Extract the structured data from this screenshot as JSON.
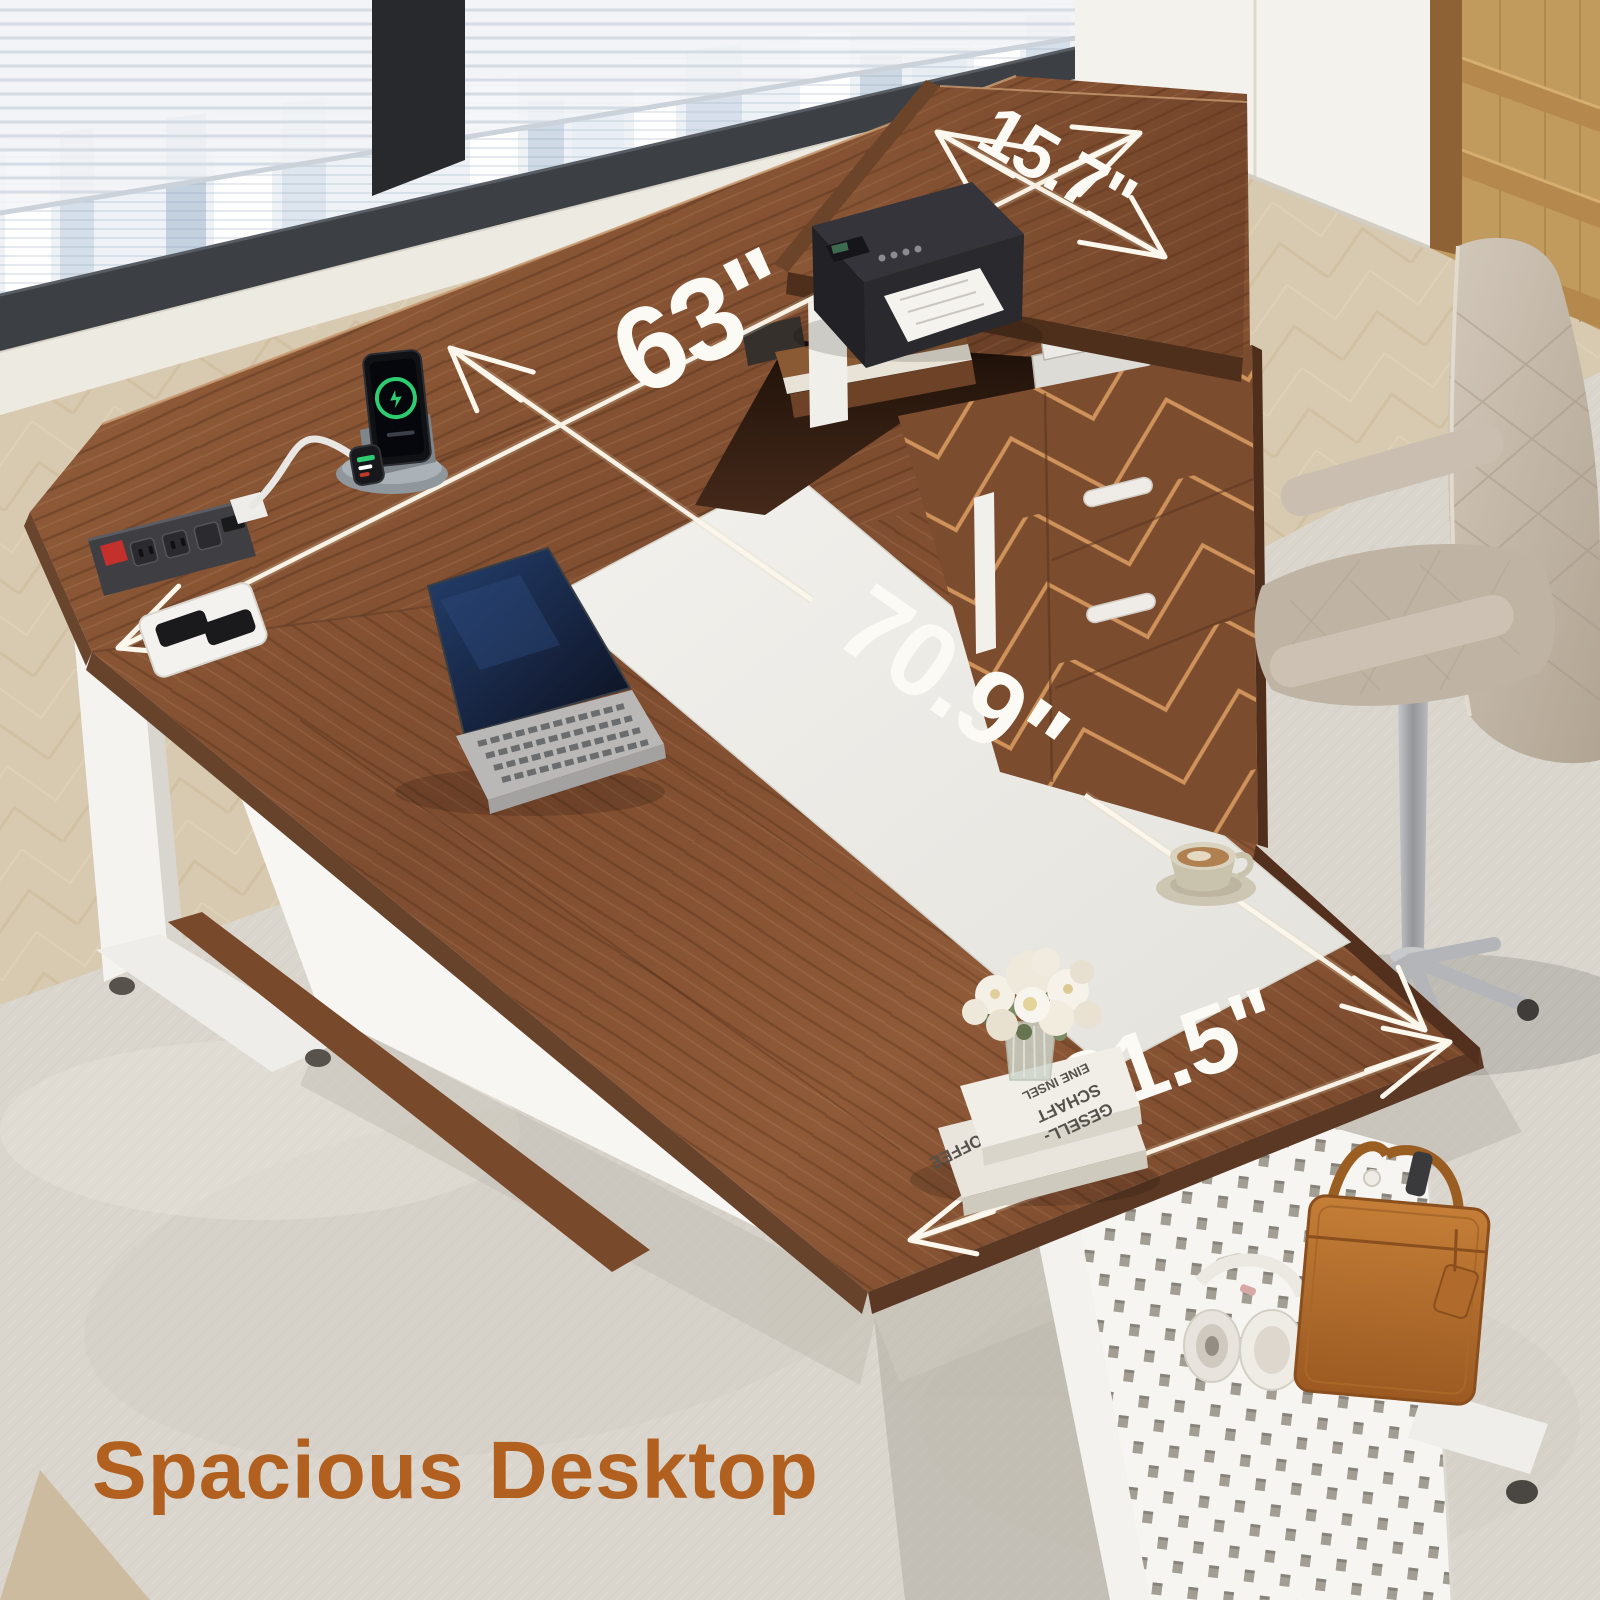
{
  "caption": {
    "text": "Spacious Desktop",
    "color": "#b2601f"
  },
  "dimensions": {
    "return_depth": {
      "value": "15.7\""
    },
    "desk_length": {
      "value": "63\""
    },
    "overall_length": {
      "value": "70.9\""
    },
    "desk_depth": {
      "value": "31.5\""
    }
  },
  "decor": {
    "book_stack": {
      "title_line1": "GESELL-",
      "title_line2": "SCHAFT",
      "title_line3": "EINE INSEL",
      "spine_text": "COFFEE"
    }
  },
  "palette": {
    "desk_wood": "#84512f",
    "frame_white": "#f4f3ef",
    "stripe_white": "#edebe6",
    "floor": "#d8cab0",
    "rug": "#dad6ce",
    "accent_text": "#b2601f",
    "annotation": "#fcfaf4"
  },
  "scene_objects": [
    "window-city-view",
    "bookshelf",
    "file-cabinet",
    "printer",
    "laptop",
    "wireless-charging-dock",
    "power-strip",
    "cable-grommet",
    "coffee-cup",
    "flower-vase",
    "book-stack",
    "office-chair",
    "pegboard-leg",
    "headphones",
    "briefcase"
  ]
}
